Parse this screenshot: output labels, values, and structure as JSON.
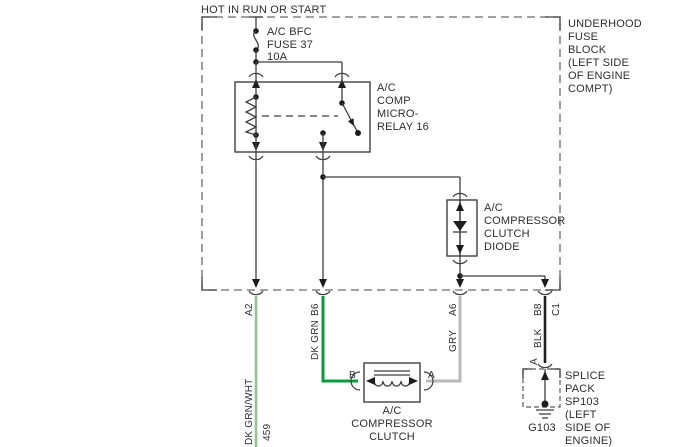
{
  "colors": {
    "diagram_line": "#3f3f3f",
    "dk_grn_wht_wire": "#8bc98b",
    "dk_grn_wire": "#0a9b3e",
    "gry_wire": "#b9b9b9",
    "blk_wire": "#1f1f1f"
  },
  "header": {
    "power_source": "HOT IN RUN OR START"
  },
  "fuse_block": {
    "label_lines": [
      "UNDERHOOD",
      "FUSE",
      "BLOCK",
      "(LEFT SIDE",
      "OF ENGINE",
      "COMPT)"
    ],
    "fuse_label_lines": [
      "A/C BFC",
      "FUSE 37",
      "10A"
    ]
  },
  "relay": {
    "label_lines": [
      "A/C",
      "COMP",
      "MICRO-",
      "RELAY 16"
    ]
  },
  "diode": {
    "label_lines": [
      "A/C",
      "COMPRESSOR",
      "CLUTCH",
      "DIODE"
    ]
  },
  "clutch": {
    "label_lines": [
      "A/C",
      "COMPRESSOR",
      "CLUTCH"
    ],
    "pin_left": "B",
    "pin_right": "A"
  },
  "splice": {
    "label_lines": [
      "SPLICE",
      "PACK",
      "SP103",
      "(LEFT",
      "SIDE OF",
      "ENGINE)"
    ],
    "pin": "A",
    "ground_id": "G103"
  },
  "terminals": {
    "a2": "A2",
    "b6": "B6",
    "a6": "A6",
    "b8": "B8",
    "c1": "C1"
  },
  "wires": {
    "dk_grn_wht": {
      "color_label": "DK GRN/WHT",
      "circuit": "459"
    },
    "dk_grn": {
      "color_label": "DK GRN"
    },
    "gry": {
      "color_label": "GRY"
    },
    "blk": {
      "color_label": "BLK"
    }
  }
}
